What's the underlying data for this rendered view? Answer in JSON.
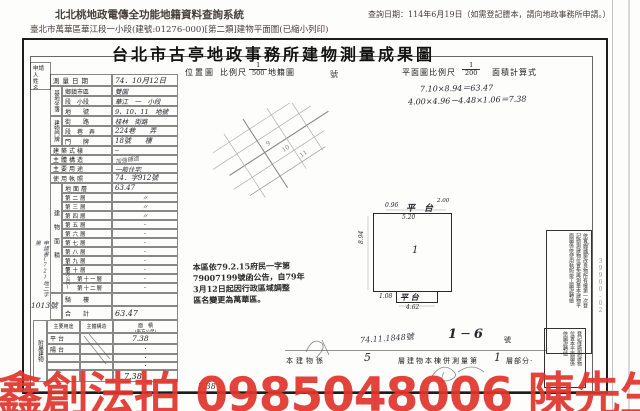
{
  "header": {
    "system_title": "北北桃地政電傳全功能地籍資料查詢系統",
    "query_date": "查詢日期：114年6月19日（如需登記謄本，請向地政事務所申請。）",
    "subtitle": "臺北市萬華區華江段一小段(建號:01276-000)[第二類]建物平面圖(已縮小列印)"
  },
  "doc": {
    "title": "台北市古亭地政事務所建物測量成果圖",
    "top": {
      "survey_label": "測量日期",
      "survey_value": "74．10月12日",
      "loc_map": "位置圖",
      "scale_label": "比例尺",
      "loc_num": "1",
      "loc_den": "500",
      "cadastral": "地籍圖",
      "build_no": "號",
      "plan_scale_label": "平面圖比例尺",
      "plan_num": "1",
      "plan_den": "200",
      "calc_label": "面積計算式",
      "calc1": "7.10×8.94＝63.47",
      "calc2": "4.00×4.96－4.48×1.06＝7.38"
    },
    "applicant": {
      "l1": "申請人",
      "l2": "姓　名"
    },
    "site": {
      "group": "基地坐落",
      "rows": [
        {
          "label": "鄉鎮市區",
          "value": "雙園"
        },
        {
          "label": "段　小段",
          "value": "華江　一　小段"
        },
        {
          "label": "地　　號",
          "value": "9、10、11　地號"
        }
      ]
    },
    "door": {
      "group": "建物門牌",
      "rows": [
        {
          "label": "街　　路",
          "value": "桂林　街路"
        },
        {
          "label": "段　巷　弄",
          "value": "224巷　　弄"
        },
        {
          "label": "門　　牌",
          "value": "18號　　樓"
        }
      ]
    },
    "info": [
      {
        "label": "建築式樣",
        "value": "─"
      },
      {
        "label": "主體構造",
        "value": "加強磚造"
      },
      {
        "label": "主要用途",
        "value": "一般住宅"
      },
      {
        "label": "使用執照",
        "value": "74．字912號"
      }
    ],
    "floors": {
      "group": "建物面積",
      "unit": "(平方公尺)",
      "rows": [
        {
          "label": "地面層",
          "value": "63.47"
        },
        {
          "label": "第二層",
          "value": "〃"
        },
        {
          "label": "第三層",
          "value": "〃"
        },
        {
          "label": "第四層",
          "value": "〃"
        },
        {
          "label": "第五層",
          "value": "·"
        },
        {
          "label": "第六層",
          "value": "·"
        },
        {
          "label": "第七層",
          "value": "·"
        },
        {
          "label": "第八層",
          "value": "·"
        },
        {
          "label": "第九層",
          "value": "·"
        },
        {
          "label": "第十層",
          "value": "·"
        },
        {
          "label": "第十一層",
          "value": "·"
        },
        {
          "label": "第十二層",
          "value": "·"
        }
      ],
      "qilou_label": "騎　樓",
      "qilou_value": "",
      "total_label": "合　計",
      "total_value": "63.47"
    },
    "annex": {
      "group": "附屬建物",
      "headers": {
        "use": "主要用途",
        "struct": "主體構造",
        "area1": "面　積",
        "area2": "(平方公尺)"
      },
      "rows": [
        {
          "use": "平台",
          "struct": "",
          "area": "7.38"
        },
        {
          "use": "陽台",
          "struct": "",
          "area": "·"
        },
        {
          "use": "",
          "struct": "",
          "area": "·"
        },
        {
          "use": "",
          "struct": "",
          "area": "·"
        }
      ],
      "total": "7.38"
    },
    "margin": {
      "note": "申請書(72)地二字第",
      "number": "1013號"
    },
    "stamp": [
      "本區依79.2.15府民一字第",
      "79007199號函公告，自79年",
      "3月12日起因行政區域調整",
      "區名變更為萬華區。"
    ],
    "plan": {
      "top_left": "0.96",
      "top_label": "平　台",
      "top_small": "2.00",
      "top_inner": "5.20",
      "left_dim": "8.94",
      "center": "1",
      "bot_left": "1.08",
      "bot_label": "平 台",
      "bot_dim": "4.62"
    },
    "bottom": {
      "scrawl": "74.11.1848號",
      "range": "1 ─ 6",
      "range_no": "號",
      "p1": "本建物係",
      "v1": "5",
      "p2": "層建物本棟併測量第",
      "v2": "1",
      "p3": "層部分·",
      "strip": "7.38"
    },
    "rstamp_a": [
      "依實施建築改良物所有權第一次登",
      "記勘測建物位置免再測量本建物平",
      "面圖係依使用執照竣工圖說轉繪"
    ],
    "rstamp_b": [
      "登記僅勘測建物",
      "位置本平面圖係",
      "依圖說轉繪"
    ],
    "edge_note": "39900-02"
  },
  "watermark": {
    "text": "鑫創法拍 0985048006 陳先生",
    "color": "#e0352b"
  }
}
